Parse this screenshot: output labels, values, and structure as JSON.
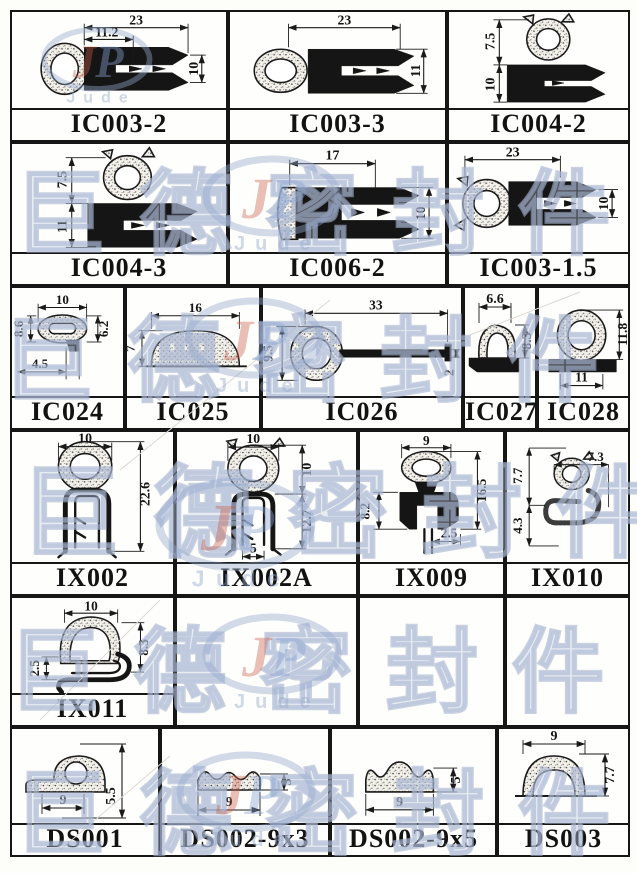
{
  "watermark": {
    "text": "巨德密封件",
    "logo_j": "J",
    "logo_p": "P",
    "logo_word": "Jude",
    "color": "#aab4d4"
  },
  "cells": [
    {
      "part": "IC003-2",
      "dims": {
        "d1": "23",
        "d2": "11.2",
        "d3": "10"
      }
    },
    {
      "part": "IC003-3",
      "dims": {
        "d1": "23",
        "d2": "11"
      }
    },
    {
      "part": "IC004-2",
      "dims": {
        "d1": "7.5",
        "d2": "10"
      }
    },
    {
      "part": "IC004-3",
      "dims": {
        "d1": "7.5",
        "d2": "11"
      }
    },
    {
      "part": "IC006-2",
      "dims": {
        "d1": "17",
        "d2": "10"
      }
    },
    {
      "part": "IC003-1.5",
      "dims": {
        "d1": "23",
        "d2": "10"
      }
    },
    {
      "part": "IC024",
      "dims": {
        "d1": "10",
        "d2": "8.6",
        "d3": "6.2",
        "d4": "4.5"
      }
    },
    {
      "part": "IC025",
      "dims": {
        "d1": "16",
        "d2": "7"
      }
    },
    {
      "part": "IC026",
      "dims": {
        "d1": "33",
        "d2": "9.5",
        "d3": "2"
      }
    },
    {
      "part": "IC027",
      "dims": {
        "d1": "6.6",
        "d2": "8.3"
      }
    },
    {
      "part": "IC028",
      "dims": {
        "d1": "11.8",
        "d2": "11"
      }
    },
    {
      "part": "IX002",
      "dims": {
        "d1": "10",
        "d2": "22.6"
      }
    },
    {
      "part": "IX002A",
      "dims": {
        "d1": "10",
        "d2": "10",
        "d3": "12.7",
        "d4": "5"
      }
    },
    {
      "part": "IX009",
      "dims": {
        "d1": "9",
        "d2": "8.2",
        "d3": "16.5",
        "d4": "2.5"
      }
    },
    {
      "part": "IX010",
      "dims": {
        "d1": "7.7",
        "d2": "7.3",
        "d3": "4.3"
      }
    },
    {
      "part": "IX011",
      "dims": {
        "d1": "10",
        "d2": "8.3",
        "d3": "2.5"
      }
    },
    {
      "part": "DS001",
      "dims": {
        "d1": "9",
        "d2": "5.5"
      }
    },
    {
      "part": "DS002-9x3",
      "dims": {
        "d1": "9",
        "d2": "3"
      }
    },
    {
      "part": "DS002-9x5",
      "dims": {
        "d1": "9",
        "d2": "5"
      }
    },
    {
      "part": "DS003",
      "dims": {
        "d1": "9",
        "d2": "7.7"
      }
    }
  ]
}
